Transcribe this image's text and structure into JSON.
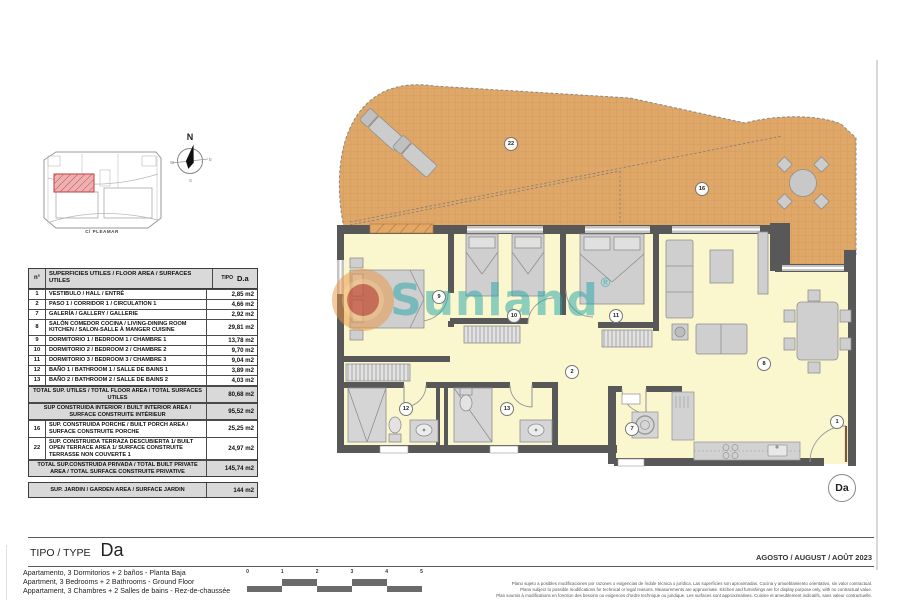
{
  "colors": {
    "terrace": "#dfa768",
    "terrace_grid": "#cf9b57",
    "interior": "#faf6ce",
    "wall": "#585858",
    "furniture": "#cfcfcf",
    "table_header_bg": "#d9d9d9",
    "site_highlight": "#eeb1b1",
    "watermark_teal": "#29a6ab",
    "watermark_orange": "#ea9440",
    "watermark_red": "#b43434"
  },
  "compass": {
    "north": "N",
    "south": "S",
    "west": "W",
    "east": "E"
  },
  "site_plan": {
    "street_label": "C/ PLEAMAR"
  },
  "plan": {
    "room_labels": {
      "r1": "1",
      "r2": "2",
      "r7": "7",
      "r8": "8",
      "r9": "9",
      "r10": "10",
      "r11": "11",
      "r12": "12",
      "r13": "13",
      "r16": "16",
      "r22": "22"
    },
    "unit_badge": "Da",
    "watermark": {
      "text": "Sunland",
      "reg": "®"
    }
  },
  "table": {
    "header": {
      "col_num": "n°",
      "col_desc": "SUPERFICIES UTILES / FLOOR AREA / SURFACES UTILES",
      "tipo_label": "TIPO",
      "tipo_value": "D.a"
    },
    "rows": [
      {
        "n": "1",
        "desc": "VESTIBULO / HALL / ENTRÉ",
        "val": "2,85 m2"
      },
      {
        "n": "2",
        "desc": "PASO 1 / CORRIDOR 1 / CIRCULATION 1",
        "val": "4,66 m2"
      },
      {
        "n": "7",
        "desc": "GALERÍA / GALLERY / GALLERIE",
        "val": "2,92 m2"
      },
      {
        "n": "8",
        "desc": "SALÓN COMEDOR COCINA / LIVING-DINING ROOM KITCHEN / SALON-SALLE À MANGER CUISINE",
        "val": "29,81 m2"
      },
      {
        "n": "9",
        "desc": "DORMITORIO 1 / BEDROOM 1 / CHAMBRE 1",
        "val": "13,78 m2"
      },
      {
        "n": "10",
        "desc": "DORMITORIO 2 / BEDROOM 2 / CHAMBRE 2",
        "val": "9,70 m2"
      },
      {
        "n": "11",
        "desc": "DORMITORIO 3 / BEDROOM 3 / CHAMBRE 3",
        "val": "9,04 m2"
      },
      {
        "n": "12",
        "desc": "BAÑO 1 / BATHROOM 1 / SALLE DE BAINS 1",
        "val": "3,89 m2"
      },
      {
        "n": "13",
        "desc": "BAÑO 2 / BATHROOM 2 / SALLE DE BAINS 2",
        "val": "4,03 m2"
      }
    ],
    "summary": {
      "s1": {
        "desc": "TOTAL SUP. UTILES / TOTAL FLOOR AREA / TOTAL SURFACES UTILES",
        "val": "80,68 m2"
      },
      "s2": {
        "desc": "SUP CONSTRUIDA INTERIOR / BUILT INTERIOR AREA / SURFACE CONSTRUITE INTÉRIEUR",
        "val": "95,52 m2"
      },
      "s3": {
        "n": "16",
        "desc": "SUP. CONSTRUIDA PORCHE / BUILT PORCH AREA / SURFACE CONSTRUITE PORCHE",
        "val": "25,25 m2"
      },
      "s4": {
        "n": "22",
        "desc": "SUP. CONSTRUIDA TERRAZA DESCUBIERTA 1/ BUILT OPEN TERRACE AREA 1/  SURFACE CONSTRUITE TERRASSE NON COUVERTE 1",
        "val": "24,97 m2"
      },
      "s5": {
        "desc": "TOTAL SUP.CONSTRUIDA PRIVADA / TOTAL  BUILT PRIVATE AREA / TOTAL SURFACE CONSTRUITE PRIVATIVE",
        "val": "145,74 m2"
      }
    },
    "garden": {
      "desc": "SUP. JARDIN / GARDEN AREA  / SURFACE JARDIN",
      "val": "144 m2"
    }
  },
  "footer": {
    "type_label": "TIPO / TYPE",
    "type_value": "Da",
    "date": "AGOSTO / AUGUST / AOÛT  2023",
    "description_lines": [
      "Apartamento, 3 Dormitorios + 2 baños - Planta Baja",
      "Apartment, 3 Bedrooms + 2 Bathrooms - Ground Floor",
      "Appartament, 3 Chambres + 2 Salles de bains - Rez-de-chaussée"
    ],
    "scale_ticks": [
      "0",
      "1",
      "2",
      "3",
      "4",
      "5"
    ],
    "disclaimer_lines": [
      "Plano sujeto a posibles modificaciones por razones o exigencias de índole técnica o jurídica. Las superficies son aproximadas. Cocina y amueblamiento orientativo, sin valor contractual.",
      "Plans subject to possible modifications for technical or legal reasons. Measurements are approximate. Kitchen and furnishings are for display purpose only, with no contractual value.",
      "Plan soumis à modifications en fonction des besoins ou exigences d'ordre technique ou juridique. Les surfaces sont approximatives. Cuisine et ameublement indicatifs, sans valeur contractuelle."
    ]
  }
}
